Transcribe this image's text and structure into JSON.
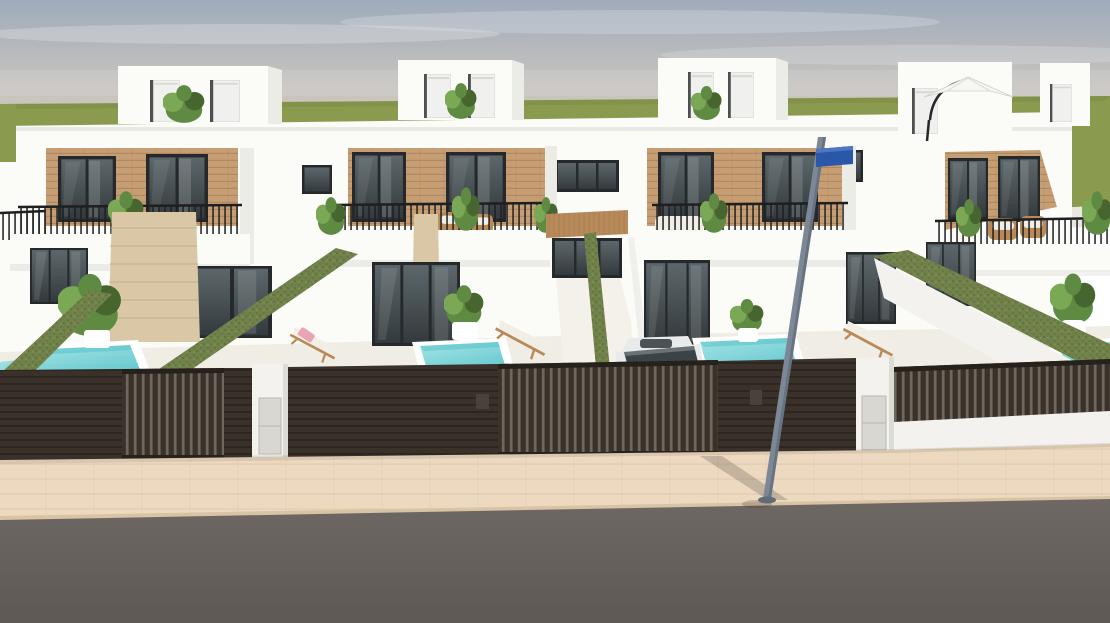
{
  "meta": {
    "title": "New-build townhouses with private pools — exterior 3D render",
    "type": "architectural-render",
    "description": "Street-level render of a row of four modern white townhouses with wood-clad upper floors, rooftop terraces with plants and a parasol, balconies with thin black railings, green artificial-grass privacy walls, small turquoise pools, sun loungers, dark slatted fencing with white utility pillars, a parked white car behind a gate, a street sign pole, beige paved sidewalk and grey asphalt road under a hazy grey-blue sky."
  },
  "scene": {
    "units_count": 4,
    "pools_count": 4,
    "objects": [
      "sky",
      "grass-horizon",
      "townhouse-row",
      "rooftop-stair-bulkheads",
      "rooftop-parasol",
      "balconies-with-railings",
      "wood-clad-upper-floor",
      "glazed-doors",
      "privacy-hedge-walls",
      "plunge-pools",
      "sun-loungers",
      "potted-plants",
      "travertine-column",
      "slatted-fence",
      "fence-gates",
      "utility-pillars",
      "parked-car",
      "street-sign-pole",
      "sidewalk",
      "road"
    ]
  },
  "palette": {
    "sky-top": "#9fabbc",
    "sky-haze": "#c9c5bd",
    "cloud": "#e2e5e8",
    "grass": "#8a9a4f",
    "grass-dark": "#798a42",
    "distant": "#e8e7e2",
    "facade": "#fbfbf8",
    "facade-shade": "#ecece7",
    "facade-dark": "#dcdcd6",
    "brick": "#c79e74",
    "brick-line": "#a9835c",
    "frame": "#26292b",
    "glass-dark": "#333a3d",
    "glass-light": "#5d676b",
    "railing": "#1d1f21",
    "hedge": "#71814a",
    "hedge-dark": "#5c6c3d",
    "hedge-light": "#8da05e",
    "terrace": "#f0ede5",
    "pool-light": "#a7e4e4",
    "pool-deep": "#4fc0c9",
    "fence": "#3a312a",
    "fence-dark": "#27211c",
    "fence-gap": "#6e675e",
    "pillar": "#f3f2ee",
    "pillar-door": "#d8d7d1",
    "sidewalk": "#ecd9c0",
    "sidewalk-line": "#d9c3a5",
    "road": "#6e6864",
    "road-dark": "#5e5955",
    "pole": "#7d8896",
    "pole-dark": "#5f6b78",
    "sign": "#2b57a8",
    "car-body": "#e9eaea",
    "car-glass": "#3a4347",
    "plant": "#5e8a42",
    "plant-dark": "#47652f",
    "plant-light": "#7aa855",
    "wood": "#b98a58",
    "stone": "#d9c7a5",
    "stone-line": "#c3b08c",
    "lounger": "#f1eee6",
    "towel": "#e9a3b2",
    "shadow": "rgba(55,46,38,0.22)"
  }
}
